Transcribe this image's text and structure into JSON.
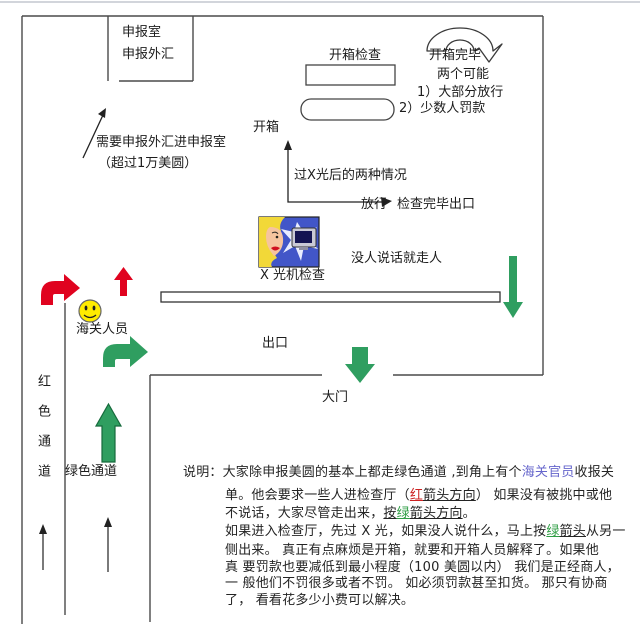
{
  "colors": {
    "red_arrow": "#e0031f",
    "red_arrow_dark": "#8f0014",
    "green_arrow": "#2f9e60",
    "green_arrow_dark": "#166a3c",
    "smiley_yellow": "#ffec00",
    "officer_link": "#6666cc",
    "red_accent": "#cc2222",
    "green_accent": "#2f9e44"
  },
  "diagram": {
    "declaration_room_line1": "申报室",
    "declaration_room_line2": "申报外汇",
    "declaration_note_line1": "需要申报外汇进申报室",
    "declaration_note_line2": "（超过1万美圆）",
    "open_box_check": "开箱检查",
    "open_box_done": "开箱完毕",
    "two_possibilities": "两个可能",
    "outcome_1": "1）大部分放行",
    "outcome_2": "2）少数人罚款",
    "open_box": "开箱",
    "after_xray_cases": "过X光后的两种情况",
    "release": "放行",
    "check_done_exit": "检查完毕出口",
    "xray_caption": "X 光机检查",
    "no_talk_walk_away": "没人说话就走人",
    "customs_officer": "海关人员",
    "red_channel": "红色通道",
    "green_channel": "绿色通道",
    "exit": "出口",
    "gate": "大门"
  },
  "note": {
    "label": "说明：",
    "l1a": "大家除申报美圆的基本上都走绿色通道 ,到角上有个",
    "l1b": "海关官员",
    "l1c": "收报关",
    "l2a": "单。他会要求一些人进检查厅（",
    "l2b": "红",
    "l2c": "箭头方向",
    "l2d": "）  如果没有被挑中或他",
    "l3a": "不说话，大家尽管走出来，",
    "l3b": "按",
    "l3c": "绿",
    "l3d": "箭头方向",
    "l3e": "。",
    "l4a": "如果进入检查厅，先过 X 光，如果没人说什么，马上按",
    "l4b": "绿",
    "l4c": "箭头",
    "l4d": "从另一",
    "l5": "侧出来。  真正有点麻烦是开箱，就要和开箱人员解释了。如果他",
    "l6": "真 要罚款也要减低到最小程度（100 美圆以内）  我们是正经商人，",
    "l7": "一 般他们不罚很多或者不罚。  如必须罚款甚至扣货。  那只有协商",
    "l8": "了，  看看花多少小费可以解决。"
  }
}
